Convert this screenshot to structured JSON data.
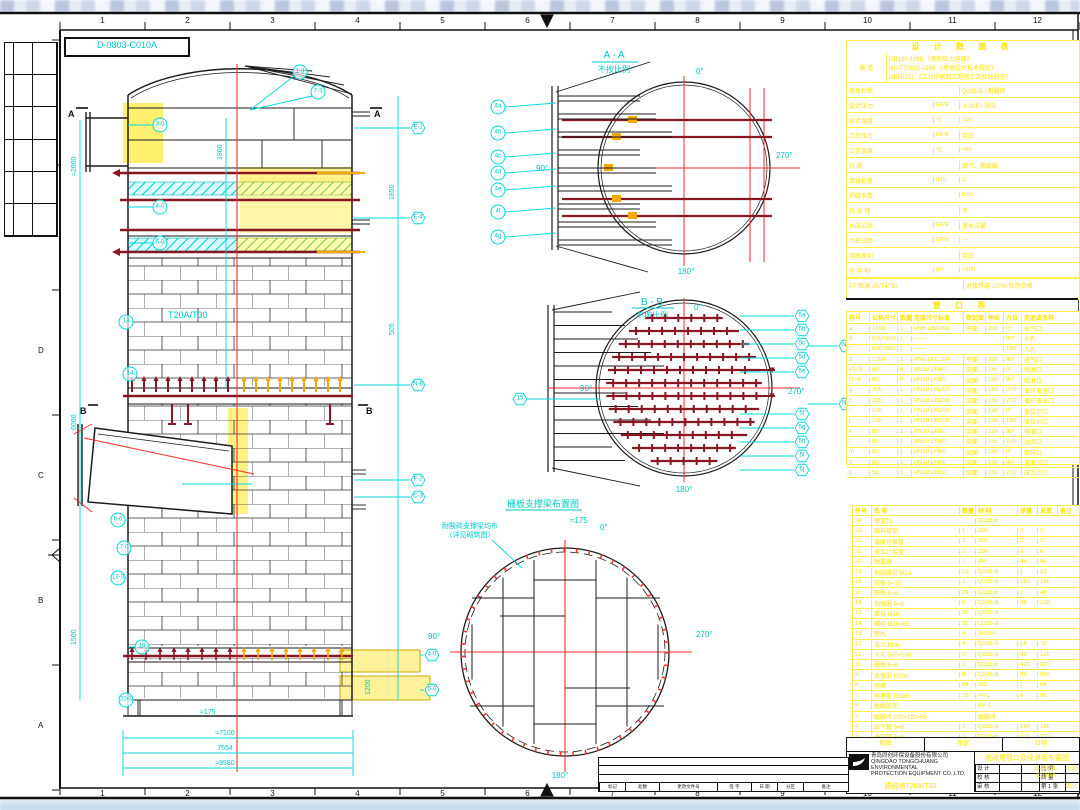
{
  "meta": {
    "drawing_no": "D-0803-C010A"
  },
  "frame": {
    "top_numbers": [
      "1",
      "2",
      "3",
      "4",
      "5",
      "6",
      "7",
      "8",
      "9",
      "10",
      "11",
      "12"
    ],
    "bottom_numbers": [
      "1",
      "2",
      "3",
      "4",
      "5",
      "6",
      "7",
      "8",
      "9",
      "10",
      "11",
      "12"
    ],
    "left_letters": [
      "F",
      "E",
      "D",
      "C",
      "B",
      "A"
    ]
  },
  "tower": {
    "tag": "T20A/T30",
    "section_a": "A",
    "section_b": "B",
    "dome_tags": [
      "1-3",
      "7-3"
    ],
    "left_tags": [
      "3-0",
      "4-0",
      "5-0",
      "13",
      "14",
      "6-0",
      "7-0",
      "12-0",
      "19",
      "20-3"
    ],
    "right_tags": [
      "E-1",
      "E-4",
      "N-6",
      "F-2",
      "C-3"
    ],
    "br_tags": [
      "4-0",
      "5-0"
    ],
    "dims_left": [
      "≈2000",
      "6000",
      "1500",
      "1900"
    ],
    "dims_right": [
      "1850",
      "505"
    ],
    "dims_bottom": [
      "≈7100",
      "7554",
      "≈9580"
    ],
    "note_175": "≈175",
    "note_1200": "1200"
  },
  "view_aa": {
    "title": "A - A",
    "note": "不按比例",
    "deg_top": "0°",
    "deg_left": "90°",
    "deg_right": "270°",
    "deg_bottom": "180°",
    "tags": [
      "4a",
      "4b",
      "4c",
      "4d",
      "4e",
      "4f",
      "4g"
    ]
  },
  "view_bb": {
    "title": "B - B",
    "note": "不按比例",
    "deg_top": "0°",
    "deg_left": "90°",
    "deg_right": "270°",
    "deg_bottom": "180°",
    "tags_right": [
      "5a",
      "5b",
      "5c",
      "5d",
      "5e",
      "5f",
      "5g",
      "5h",
      "5i",
      "5j"
    ],
    "tags_far": [
      "N5",
      "N7"
    ],
    "tag_left": "15"
  },
  "view_grid": {
    "title": "栅板支撑梁布置图",
    "note_line1": "耐酸砖支撑梁均布",
    "note_line2": "（详见砌筑图）",
    "dim": "≈175",
    "deg_top": "0°",
    "deg_left": "90°",
    "deg_right": "270°",
    "deg_bottom": "180°"
  },
  "design_table": {
    "title": "设 计 数 据 表",
    "spec_label": "规 范",
    "spec_lines": [
      "GB150-1998 《钢制压力容器》",
      "HG/T20652-1998 《塔器设计技术规定》",
      "GB50211 《工业炉砌筑工程施工及验收规范》"
    ],
    "rows": [
      [
        "塔体材质",
        "",
        "Q235-B / 耐酸砖"
      ],
      [
        "设计压力",
        "MPa",
        "-0.005 / 常压"
      ],
      [
        "设计温度",
        "℃",
        "150"
      ],
      [
        "工作压力",
        "MPa",
        "常压"
      ],
      [
        "工作温度",
        "℃",
        "≤80"
      ],
      [
        "介  质",
        "",
        "烟气、稀硫酸"
      ],
      [
        "腐蚀裕量",
        "mm",
        "2"
      ],
      [
        "焊缝系数",
        "",
        "0.85"
      ],
      [
        "热 处 理",
        "",
        "不"
      ],
      [
        "水压试验",
        "MPa",
        "盛水试漏"
      ],
      [
        "气密试验",
        "MPa",
        "—"
      ],
      [
        "容器类别",
        "",
        "常压"
      ],
      [
        "全 容 积",
        "m³",
        "≈280"
      ]
    ],
    "footer_left": "PT 检测 JB/T4730",
    "footer_right": "对接焊缝 100% 检测合格"
  },
  "nozzle_table": {
    "title": "管 口 表",
    "headers": [
      "符号",
      "公称尺寸",
      "数量",
      "连接尺寸标准",
      "密封面",
      "伸出",
      "方位",
      "用途或名称"
    ],
    "rows": [
      [
        "a",
        "1400",
        "1",
        "PN6 DN1400",
        "平面",
        "200",
        "0°",
        "出气口"
      ],
      [
        "b",
        "500×500",
        "1",
        "——",
        "",
        "",
        "90°",
        "人孔"
      ],
      [
        "c",
        "500×500",
        "1",
        "——",
        "",
        "",
        "180°",
        "人孔"
      ],
      [
        "d",
        "1200",
        "1",
        "PN6 DN1200",
        "平面",
        "200",
        "90°",
        "进气口"
      ],
      [
        "e1~8",
        "80",
        "8",
        "PN10 DN80",
        "突面",
        "150",
        "0°",
        "喷淋口"
      ],
      [
        "f1~8",
        "80",
        "8",
        "PN10 DN80",
        "突面",
        "150",
        "90°",
        "喷淋口"
      ],
      [
        "g",
        "200",
        "1",
        "PN10 DN200",
        "突面",
        "150",
        "270°",
        "循环液进口"
      ],
      [
        "h",
        "200",
        "1",
        "PN10 DN200",
        "突面",
        "150",
        "270°",
        "循环液出口"
      ],
      [
        "i",
        "100",
        "1",
        "PN10 DN100",
        "突面",
        "150",
        "0°",
        "液位计口"
      ],
      [
        "j",
        "100",
        "1",
        "PN10 DN100",
        "突面",
        "150",
        "180°",
        "液位计口"
      ],
      [
        "k",
        "80",
        "1",
        "PN10 DN80",
        "突面",
        "150",
        "90°",
        "排液口"
      ],
      [
        "l",
        "80",
        "1",
        "PN10 DN80",
        "突面",
        "150",
        "270°",
        "溢流口"
      ],
      [
        "m",
        "50",
        "1",
        "PN10 DN50",
        "突面",
        "150",
        "0°",
        "取样口"
      ],
      [
        "n",
        "50",
        "1",
        "PN10 DN50",
        "突面",
        "150",
        "90°",
        "温度计口"
      ],
      [
        "p",
        "50",
        "1",
        "PN10 DN50",
        "突面",
        "150",
        "270°",
        "压力计口"
      ]
    ]
  },
  "bom_table": {
    "headers": [
      "件号",
      "名  称",
      "数量",
      "材 料",
      "单重",
      "总重",
      "备注"
    ],
    "rows": [
      [
        "24",
        "保温钉",
        "",
        "Q235-B",
        "",
        "",
        ""
      ],
      [
        "23",
        "取样接管",
        "1",
        "20#",
        "2",
        "2",
        ""
      ],
      [
        "22",
        "温度计接管",
        "1",
        "20#",
        "2",
        "2",
        ""
      ],
      [
        "21",
        "液位计接管",
        "2",
        "20#",
        "3",
        "6",
        ""
      ],
      [
        "20",
        "除雾器",
        "1",
        "PP",
        "45",
        "45",
        ""
      ],
      [
        "19",
        "地脚螺栓 M24",
        "12",
        "Q235-B",
        "1",
        "12",
        ""
      ],
      [
        "18",
        "底板 δ=12",
        "1",
        "Q235-B",
        "160",
        "160",
        ""
      ],
      [
        "17",
        "筋板 δ=8",
        "24",
        "Q235-B",
        "2",
        "48",
        ""
      ],
      [
        "16",
        "加强圈 δ=8",
        "6",
        "Q235-B",
        "38",
        "228",
        ""
      ],
      [
        "15",
        "螺母 M16",
        "32",
        "Q235-B",
        "",
        "",
        ""
      ],
      [
        "14",
        "螺栓 M16×60",
        "32",
        "Q235-B",
        "",
        "",
        ""
      ],
      [
        "13",
        "垫片",
        "4",
        "XB350",
        "",
        "",
        ""
      ],
      [
        "12",
        "法兰 PN6",
        "4",
        "Q235-A",
        "18",
        "72",
        ""
      ],
      [
        "11",
        "人孔 500×500",
        "2",
        "Q235-B",
        "60",
        "120",
        ""
      ],
      [
        "10",
        "栅板 δ=6",
        "1",
        "Q235-B",
        "420",
        "420",
        ""
      ],
      [
        "9",
        "支撑梁 H200",
        "8",
        "Q235-B",
        "85",
        "680",
        ""
      ],
      [
        "8",
        "喷嘴",
        "64",
        "SiC",
        "1",
        "64",
        ""
      ],
      [
        "7",
        "喷淋管 DN80",
        "16",
        "PVC",
        "6",
        "96",
        ""
      ],
      [
        "6",
        "耐酸胶泥",
        "",
        "KP-1",
        "",
        "",
        ""
      ],
      [
        "5",
        "耐酸砖 230×113×65",
        "",
        "耐酸砖",
        "",
        "",
        ""
      ],
      [
        "4",
        "出气管 δ=8",
        "1",
        "Q235-B",
        "180",
        "180",
        ""
      ],
      [
        "3",
        "进气管 δ=8",
        "1",
        "Q235-B",
        "210",
        "210",
        ""
      ],
      [
        "2",
        "上封头 δ=8",
        "1",
        "Q235-B",
        "520",
        "520",
        ""
      ],
      [
        "1",
        "筒体 δ=8",
        "1",
        "Q235-B",
        "6800",
        "6800",
        ""
      ]
    ]
  },
  "title_block": {
    "top_cells": [
      "制图",
      "审定",
      "日期"
    ],
    "company_line1": "青岛同创环保设备股份有限公司",
    "company_line2": "QINGDAO TONGCHUANG ENVIRONMENTAL",
    "company_line3": "PROTECTION EQUIPMENT CO.,LTD.",
    "product_name": "脱硫塔T20A/T30",
    "drawing_title": "脱硫塔管口及喷淋层布置图",
    "grid_rows": [
      [
        "设 计",
        "",
        "",
        "比 例",
        "1:30"
      ],
      [
        "校 核",
        "",
        "",
        "质 量",
        ""
      ],
      [
        "审 核",
        "",
        "",
        "第 1 张",
        "共 1 张"
      ]
    ],
    "drawing_no_line1": "D-0803-",
    "drawing_no_line2": "C010A"
  },
  "revision_strip": {
    "labels": [
      "标记",
      "处数",
      "更改文件号",
      "签 字",
      "日 期",
      "分区",
      "备注"
    ]
  }
}
